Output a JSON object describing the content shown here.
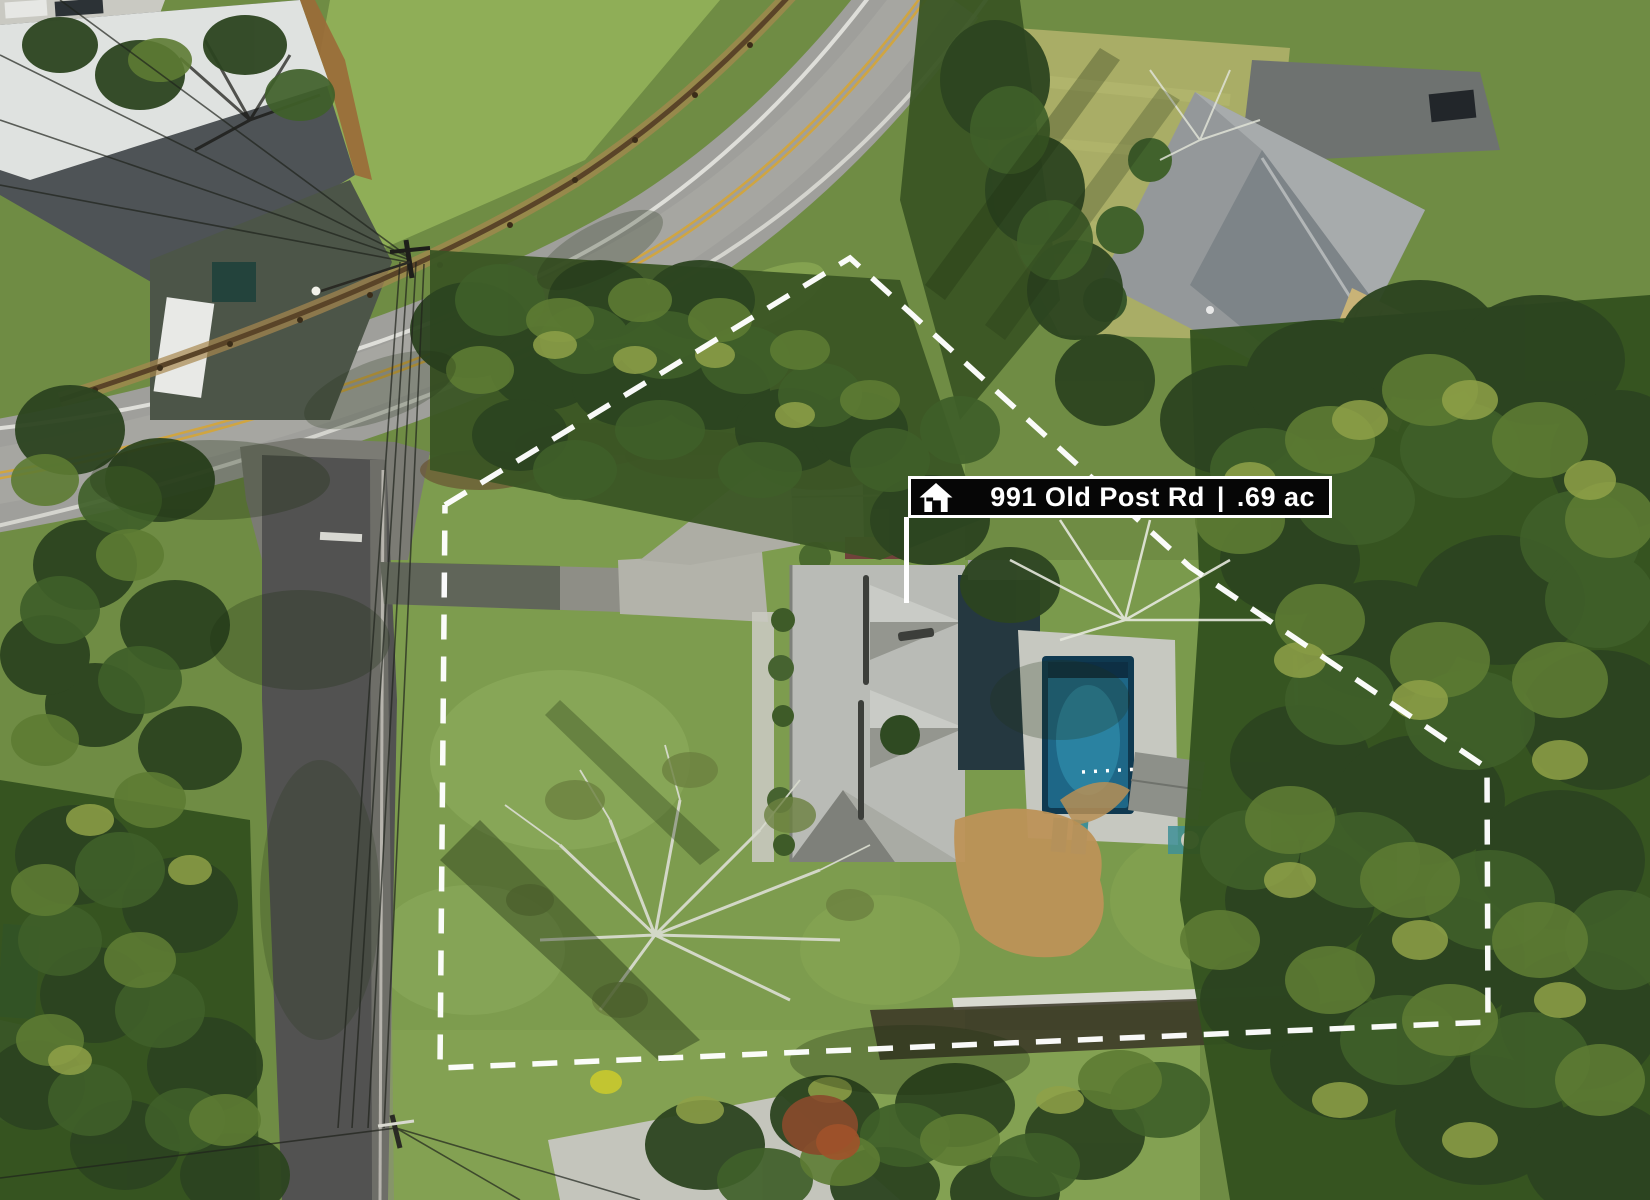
{
  "banner": {
    "address": "991 Old Post Rd",
    "divider": "|",
    "area": ".69 ac",
    "icon": "house-icon"
  },
  "colors": {
    "banner_bg": "#060606",
    "banner_border": "#ffffff",
    "banner_text": "#ffffff",
    "boundary": "#ffffff",
    "pool_water": "#1e6787",
    "pool_coping": "#0f3950",
    "asphalt_main": "#9f9f9b",
    "asphalt_side": "#525251",
    "lane_yellow": "#d2a43c",
    "lawn_green": "#7d9c4e",
    "roof_subject": "#b9bbb6",
    "roof_neighbor": "#94989a",
    "deck_tan": "#c9b377",
    "dirt_tan": "#bd9257"
  }
}
